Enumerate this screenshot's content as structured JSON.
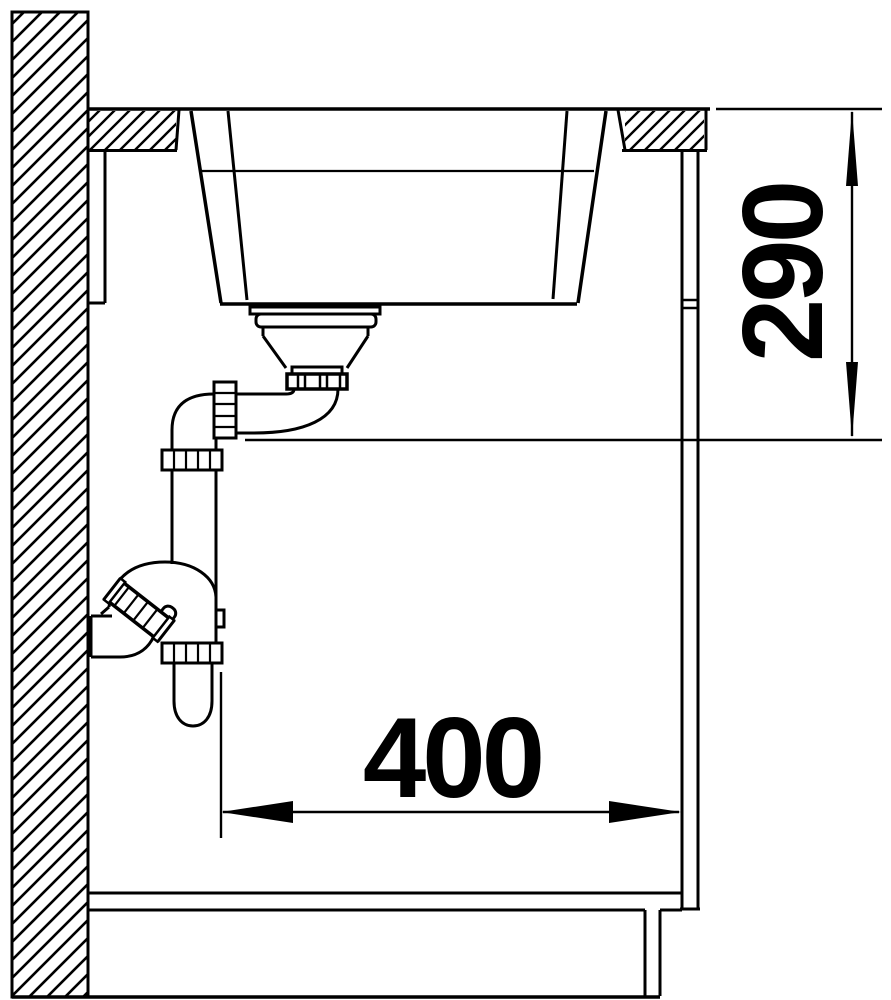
{
  "drawing": {
    "type": "technical-section-drawing",
    "dimensions": {
      "vertical": {
        "value": "290"
      },
      "horizontal": {
        "value": "400"
      }
    },
    "colors": {
      "line": "#000000",
      "background": "#ffffff"
    },
    "components": [
      "wall",
      "worktop",
      "sink-basin",
      "strainer-drain",
      "drain-pipe",
      "siphon-trap",
      "wall-outlet-pipe",
      "wall-mounting-rail",
      "cabinet-side-panel",
      "cabinet-bottom-shelf",
      "plinth",
      "floor"
    ]
  }
}
